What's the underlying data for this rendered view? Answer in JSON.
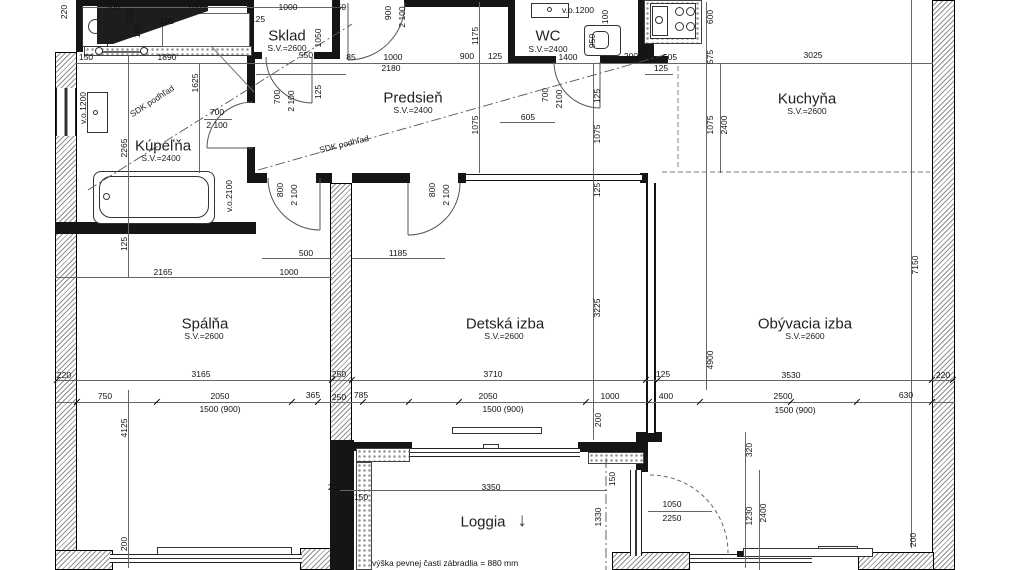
{
  "rooms": [
    {
      "name": "Kúpeľňa",
      "sv": "S.V.=2400"
    },
    {
      "name": "Sklad",
      "sv": "S.V.=2600"
    },
    {
      "name": "Predsieň",
      "sv": "S.V.=2400"
    },
    {
      "name": "WC",
      "sv": "S.V.=2400"
    },
    {
      "name": "Kuchyňa",
      "sv": "S.V.=2600"
    },
    {
      "name": "Spálňa",
      "sv": "S.V.=2600"
    },
    {
      "name": "Detská izba",
      "sv": "S.V.=2600"
    },
    {
      "name": "Obývacia izba",
      "sv": "S.V.=2600"
    },
    {
      "name": "Loggia",
      "sv": ""
    }
  ],
  "ceiling_labels": [
    "SDK podhľad",
    "SDK podhľad"
  ],
  "note": "výška pevnej časti zábradlia = 880 mm",
  "icons": {
    "down_arrow": "↓"
  },
  "dims": [
    "220",
    "900",
    "530",
    "105",
    "105",
    "1035",
    "1000",
    "250",
    "125",
    "900",
    "2 100",
    "1050",
    "1175",
    "v.o.1200",
    "100",
    "950",
    "600",
    "150",
    "1890",
    "550",
    "85",
    "1000",
    "900",
    "125",
    "1400",
    "200",
    "505",
    "575",
    "3025",
    "2180",
    "125",
    "1625",
    "700",
    "2 100",
    "700",
    "2 100",
    "125",
    "700",
    "2100",
    "605",
    "125",
    "1075",
    "1075",
    "1075",
    "2400",
    "v.o.1200",
    "2265",
    "v.o.2100",
    "800",
    "2 100",
    "800",
    "2 100",
    "125",
    "125",
    "500",
    "1185",
    "2165",
    "1000",
    "3225",
    "4900",
    "7150",
    "220",
    "3165",
    "250",
    "3710",
    "125",
    "3530",
    "220",
    "750",
    "2050",
    "365",
    "250",
    "785",
    "2050",
    "1000",
    "400",
    "2500",
    "630",
    "1500 (900)",
    "1500 (900)",
    "1500 (900)",
    "4125",
    "200",
    "235",
    "150",
    "3350",
    "1330",
    "150",
    "200",
    "320",
    "1230",
    "2400",
    "1050",
    "2250",
    "200"
  ]
}
